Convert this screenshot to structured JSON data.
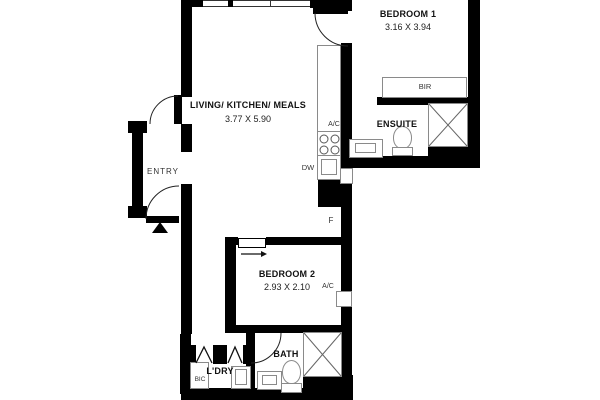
{
  "rooms": {
    "living": {
      "name": "LIVING/ KITCHEN/ MEALS",
      "dims": "3.77 X 5.90"
    },
    "bedroom1": {
      "name": "BEDROOM 1",
      "dims": "3.16 X 3.94"
    },
    "bedroom2": {
      "name": "BEDROOM 2",
      "dims": "2.93 X 2.10"
    },
    "ensuite": {
      "name": "ENSUITE"
    },
    "bath": {
      "name": "BATH"
    },
    "laundry": {
      "name": "L'DRY"
    },
    "entry": {
      "name": "ENTRY"
    }
  },
  "labels": {
    "bir": "BIR",
    "bic": "BIC",
    "dishwasher": "DW",
    "fridge": "F",
    "ac_kitchen": "A/C",
    "ac_bedroom2": "A/C"
  },
  "colors": {
    "wall": "#000000",
    "fixture_border": "#8a8a8a",
    "background": "#ffffff",
    "text": "#111111"
  }
}
